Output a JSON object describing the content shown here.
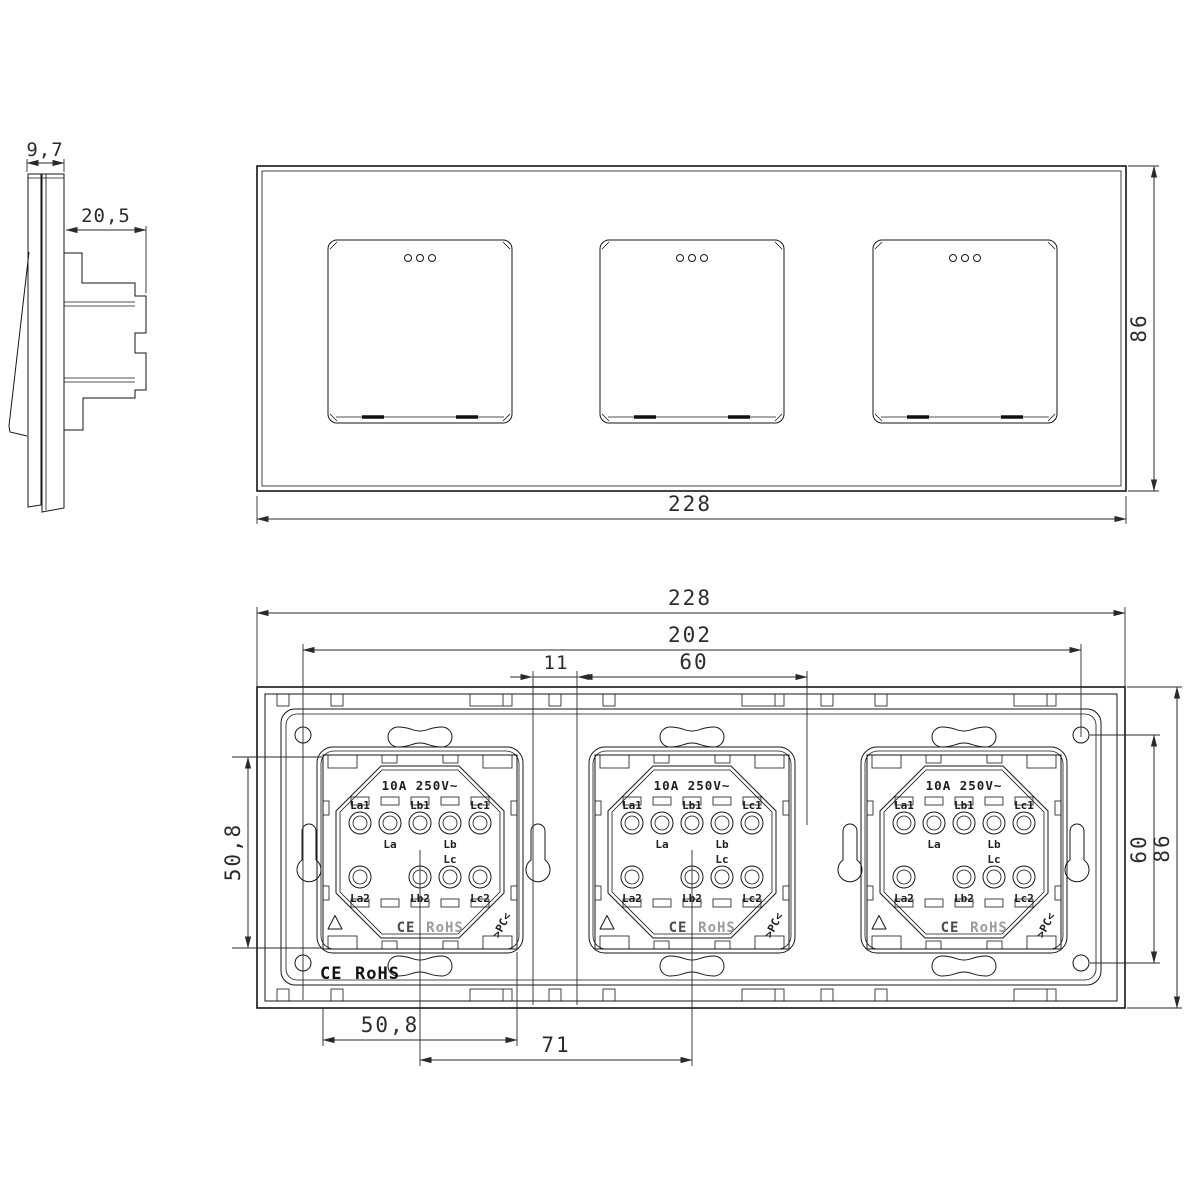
{
  "drawing": {
    "side_view": {
      "dim_panel_depth": "9,7",
      "dim_box_depth": "20,5"
    },
    "front_view": {
      "dim_width": "228",
      "dim_height": "86"
    },
    "back_view": {
      "dim_width": "228",
      "dim_screw_span": "202",
      "dim_module_width": "60",
      "dim_module_gap": "11",
      "dim_frame_height": "50,8",
      "dim_screw_height": "60",
      "dim_height": "86",
      "dim_frame_width": "50,8",
      "dim_module_pitch": "71",
      "ce_mark": "CE",
      "rohs_mark": "RoHS"
    },
    "mechanism": {
      "rating": "10A 250V~",
      "ce_mark": "CE",
      "rohs_mark": "RoHS",
      "material_code": ">PC<",
      "terminals": {
        "la1": "La1",
        "la": "La",
        "lb1": "Lb1",
        "lb": "Lb",
        "lc1": "Lc1",
        "la2": "La2",
        "lb2": "Lb2",
        "lc": "Lc",
        "lc2": "Lc2"
      }
    }
  }
}
